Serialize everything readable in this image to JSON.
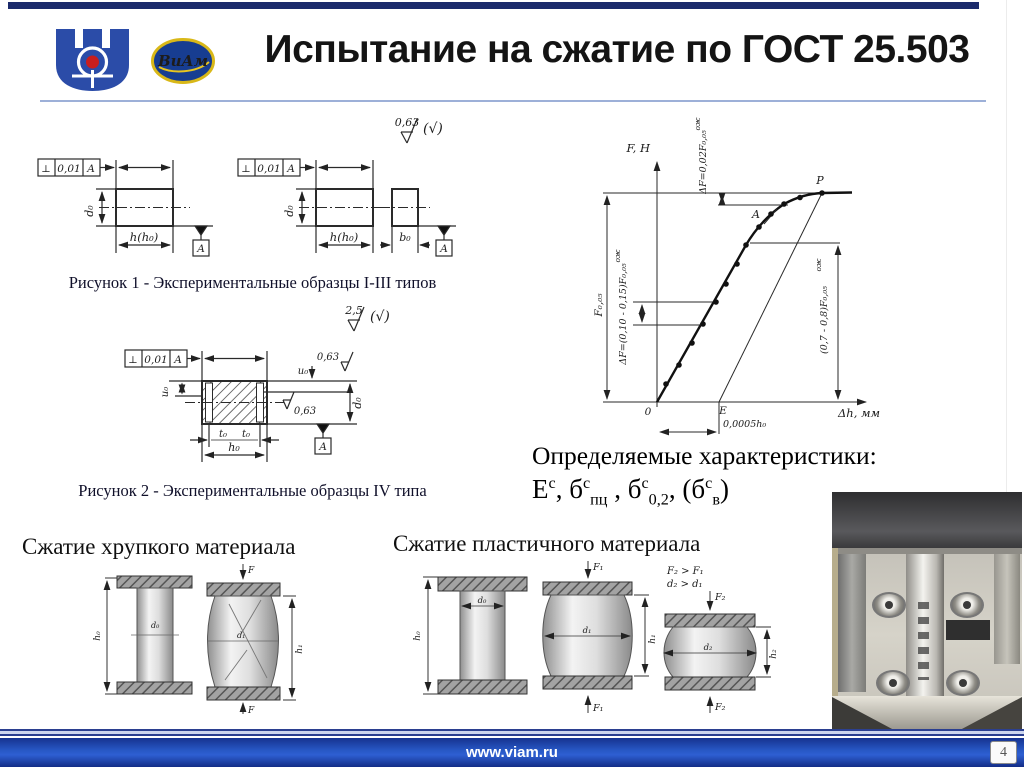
{
  "header": {
    "title": "Испытание на сжатие по ГОСТ 25.503",
    "logo_viam_text": "ВиАм"
  },
  "figure1": {
    "caption": "Рисунок 1 - Экспериментальные образцы I-III типов",
    "roughness": "0,63",
    "rough_suffix": "(√)",
    "tol_sym": "⊥",
    "tol_val": "0,01",
    "datum": "A",
    "d0": "d₀",
    "h": "h(h₀)",
    "b0": "b₀"
  },
  "figure2": {
    "caption": "Рисунок 2 - Экспериментальные образцы IV типа",
    "roughness": "2,5",
    "rough_suffix": "(√)",
    "tol_sym": "⊥",
    "tol_val": "0,01",
    "datum": "A",
    "u0": "u₀",
    "r063": "0,63",
    "d0": "d₀",
    "t0": "t₀",
    "h0": "h₀"
  },
  "chart": {
    "y_label": "F, H",
    "x_label": "Δh, мм",
    "origin": "0",
    "p": "P",
    "a": "A",
    "e": "E",
    "offset": "0,0005h₀",
    "delta_top": "ΔF=0,02F₀,₀₅",
    "delta_mid": "ΔF=(0,10 - 0,15)F₀,₀₅",
    "sup": "ож",
    "f005": "F₀,₀₅",
    "right": "(0,7 - 0,8)F₀,₀₅"
  },
  "characteristics": {
    "heading": "Определяемые характеристики:",
    "t1_base": "E",
    "t1_sup": "с",
    "t1_trail": ", ",
    "t2_base": "б",
    "t2_sup": "с",
    "t2_sub": "пц",
    "t2_trail": " , ",
    "t3_base": "б",
    "t3_sup": "с",
    "t3_sub": "0,2",
    "t3_trail": ", (",
    "t4_base": "б",
    "t4_sup": "с",
    "t4_sub": "в",
    "t4_trail": ")"
  },
  "brittle": {
    "heading": "Сжатие хрупкого материала",
    "f": "F",
    "h0": "h₀",
    "d0": "d₀",
    "h1": "h₁",
    "d1": "d₁"
  },
  "plastic": {
    "heading": "Сжатие пластичного материала",
    "f1": "F₁",
    "f2": "F₂",
    "d0": "d₀",
    "d1": "d₁",
    "d2": "d₂",
    "h0": "h₀",
    "h1": "h₁",
    "h2": "h₂",
    "cond1": "F₂ > F₁",
    "cond2": "d₂ > d₁"
  },
  "footer": {
    "url": "www.viam.ru",
    "page": "4"
  }
}
